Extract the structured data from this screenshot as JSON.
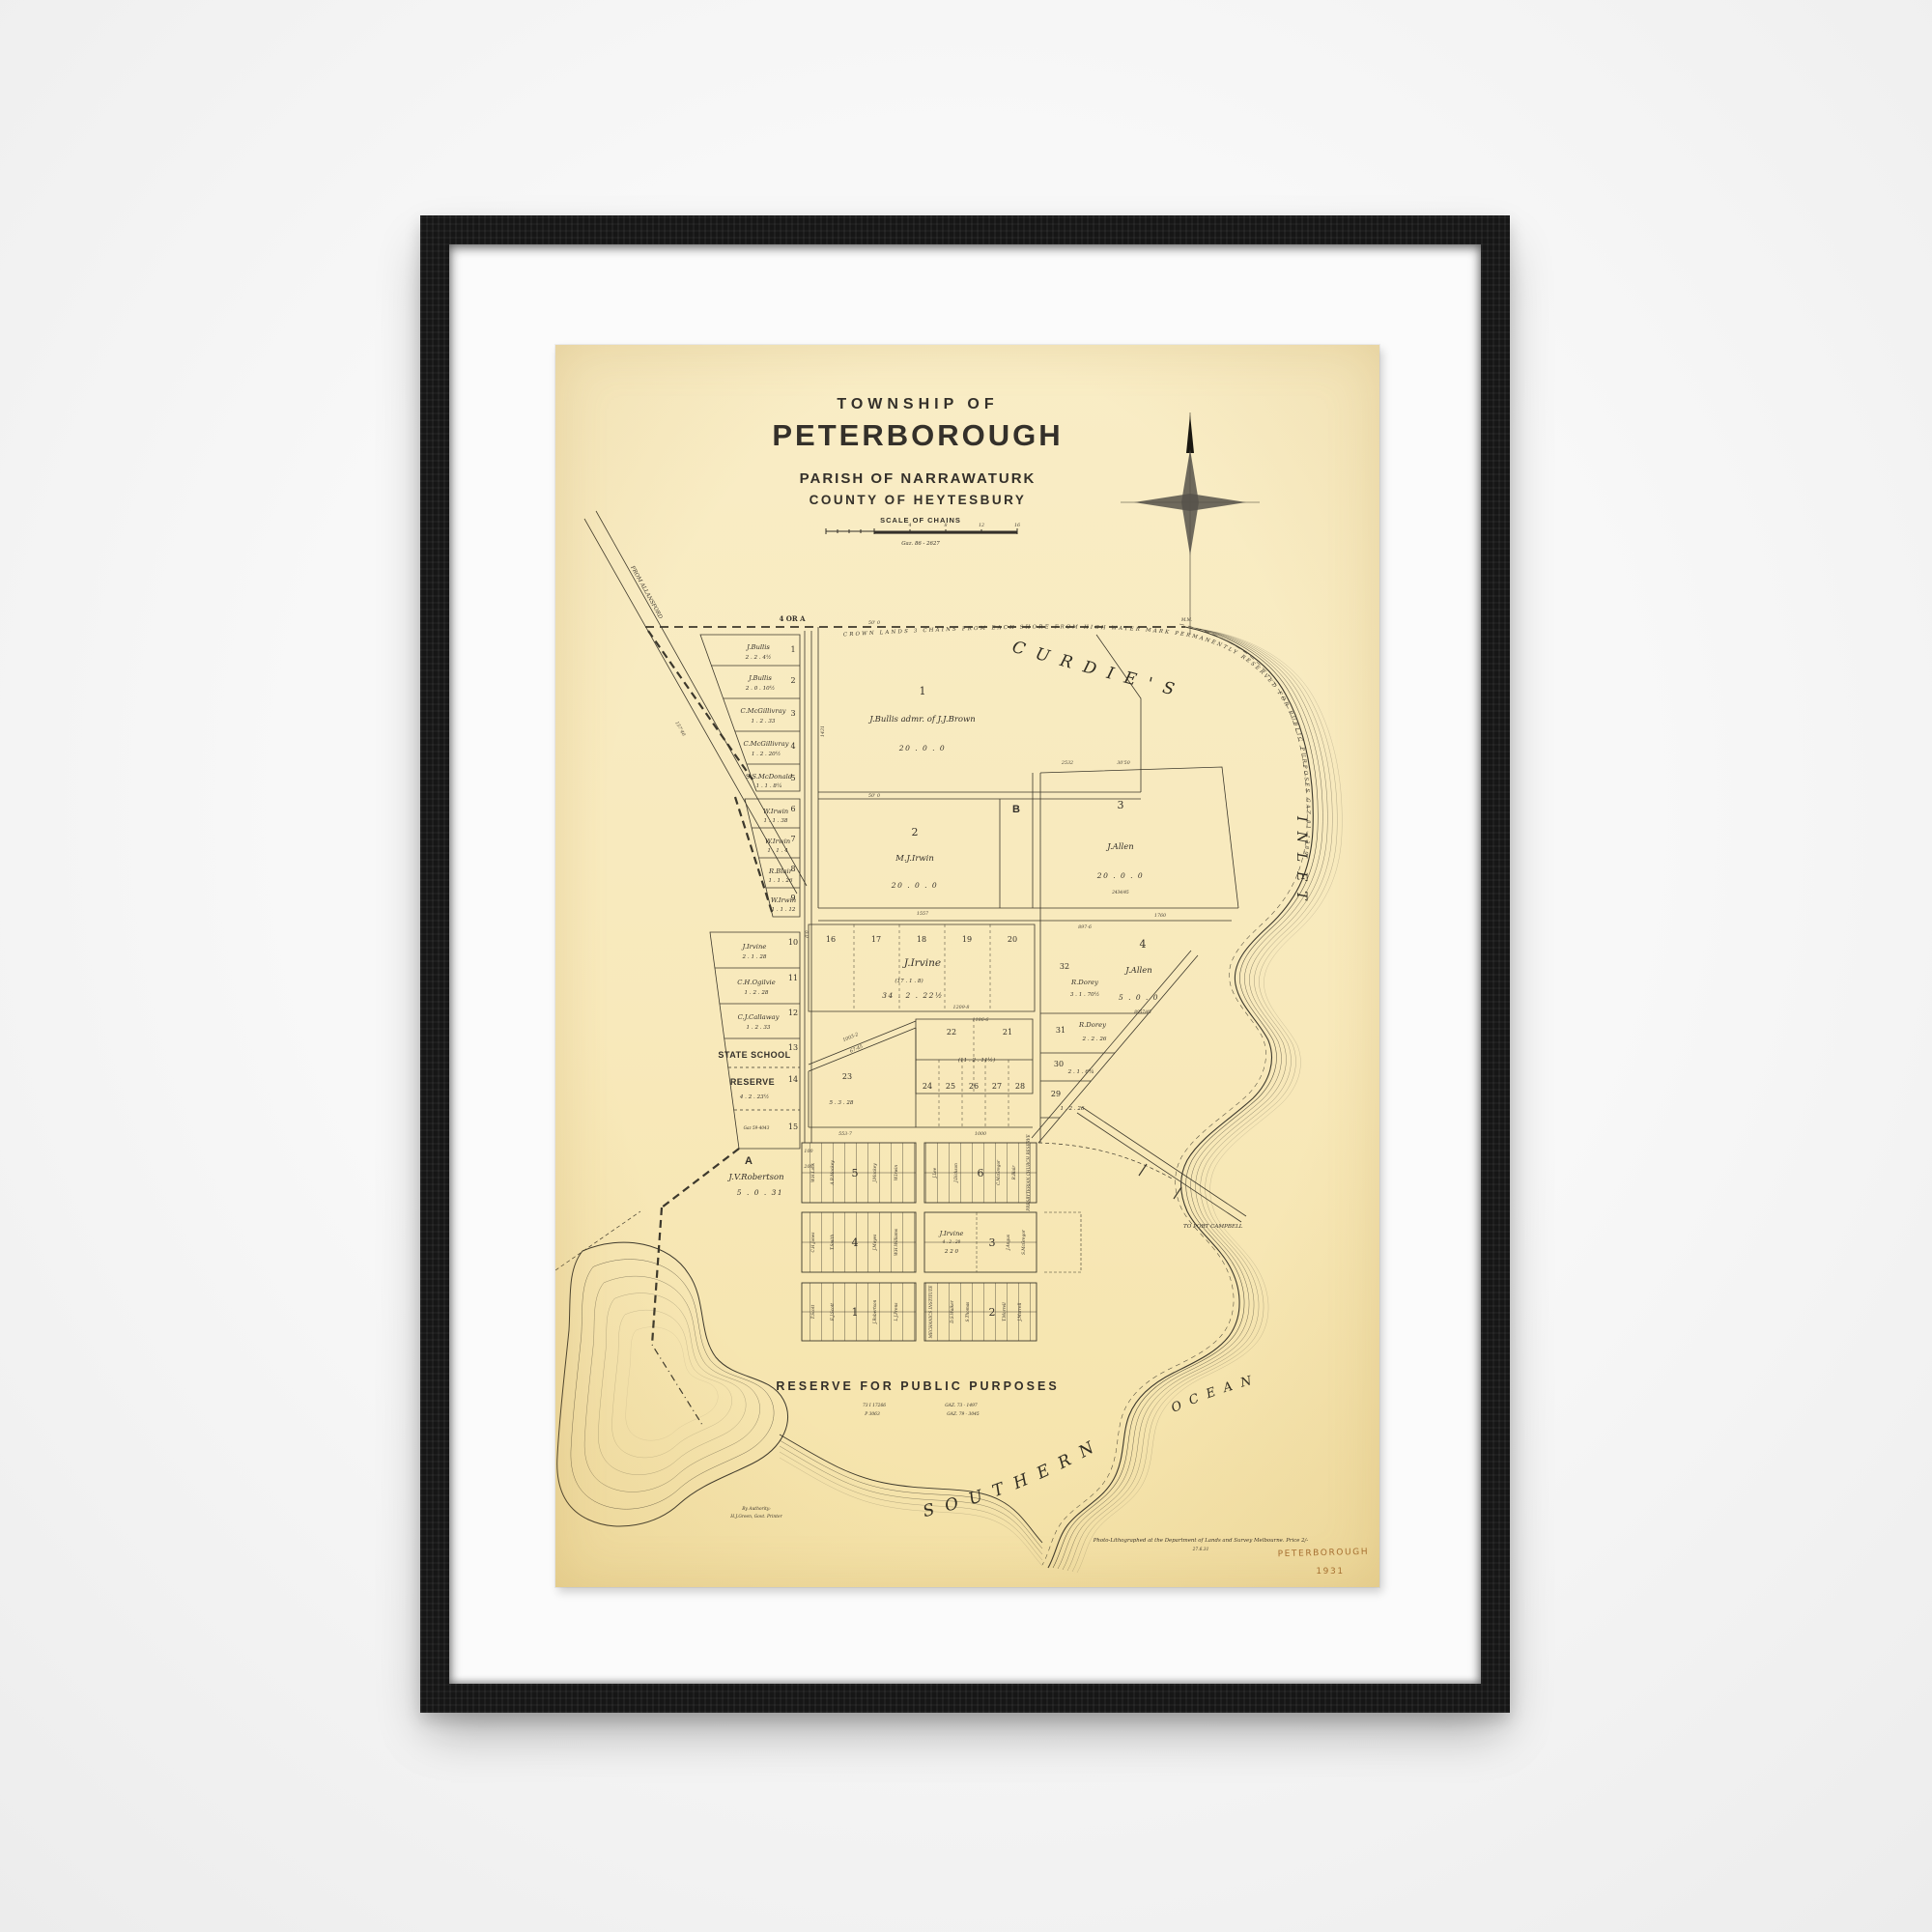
{
  "colors": {
    "background": "#f0f0f0",
    "frame": "#161616",
    "mat": "#fbfbfb",
    "paper": "#f8e9bb",
    "ink": "#34302a",
    "handwriting": "#a2692e"
  },
  "artwork": {
    "title_block": {
      "line1": "TOWNSHIP OF",
      "line2": "PETERBOROUGH",
      "line3": "PARISH OF NARRAWATURK",
      "line4": "COUNTY OF HEYTESBURY",
      "scale_label": "SCALE OF CHAINS",
      "scale_ticks": [
        "4",
        "8",
        "12",
        "16"
      ],
      "gazette_ref": "Gaz. 86 - 2627"
    },
    "boundary_label": "4 OR A",
    "benchmark": "M.M.",
    "roads": {
      "allansford": "FROM ALLANSFORD",
      "port_campbell": "TO PORT CAMPBELL"
    },
    "crown_reserve_note": "CROWN LANDS 3 CHAINS FROM EACH SHORE FROM HIGH WATER MARK PERMANENTLY RESERVED FOR PUBLIC PURPOSES GAZ 81-1389",
    "water": {
      "w1": "CURDIE'S",
      "w2": "INLET",
      "w3": "SOUTHERN",
      "w4": "OCEAN"
    },
    "left_lots": [
      {
        "n": "1",
        "name": "J.Bullis",
        "area": "2 . 2 . 4½"
      },
      {
        "n": "2",
        "name": "J.Bullis",
        "area": "2 . 0 . 10½"
      },
      {
        "n": "3",
        "name": "C.McGillivray",
        "area": "1 . 2 . 33"
      },
      {
        "n": "4",
        "name": "C.McGillivray",
        "area": "1 . 2 . 20½"
      },
      {
        "n": "5",
        "name": "S.S.McDonald",
        "area": "1 . 1 . 8¼"
      },
      {
        "n": "6",
        "name": "W.Irwin",
        "area": "1 . 1 . 38"
      },
      {
        "n": "7",
        "name": "W.Irwin",
        "area": "1 . 1 . 4"
      },
      {
        "n": "8",
        "name": "R.Blair",
        "area": "1 . 1 . 26"
      },
      {
        "n": "9",
        "name": "W.Irwin",
        "area": "1 . 1 . 12"
      }
    ],
    "mid_lots": [
      {
        "n": "10",
        "name": "J.Irvine",
        "area": "2 . 1 . 28"
      },
      {
        "n": "11",
        "name": "C.H.Ogilvie",
        "area": "1 . 2 . 28"
      },
      {
        "n": "12",
        "name": "C.J.Callaway",
        "area": "1 . 2 . 33"
      }
    ],
    "school": {
      "n13": "13",
      "line1": "STATE SCHOOL",
      "line2": "RESERVE",
      "n14": "14",
      "area": "4 . 2 . 23½",
      "n15": "15",
      "gaz": "Gaz 59-4043"
    },
    "parcels": {
      "p1": {
        "n": "1",
        "name": "J.Bullis admr. of J.J.Brown",
        "area": "20 . 0 . 0"
      },
      "p2": {
        "n": "2",
        "name": "M.J.Irwin",
        "area": "20 . 0 . 0"
      },
      "pb": "B",
      "p3": {
        "n": "3",
        "name": "J.Allen",
        "area": "20 . 0 . 0",
        "ref": "2434/45"
      },
      "p4": {
        "n": "4",
        "name": "J.Allen",
        "area": "5 . 0 . 0",
        "ref": "8957/45"
      },
      "p32": {
        "n": "32",
        "name": "R.Dorey",
        "area": "3 . 1 . 70½"
      },
      "p31": {
        "n": "31",
        "name": "R.Dorey",
        "area": "2 . 2 . 26"
      },
      "p30": {
        "n": "30",
        "area": "2 . 1 . 6¾"
      },
      "p29": {
        "n": "29",
        "area": "1 . 2 . 26"
      }
    },
    "irvine_block": {
      "n16": "16",
      "n17": "17",
      "n18": "18",
      "n19": "19",
      "n20": "20",
      "name": "J.Irvine",
      "area_small": "(17 . 1 . 8)",
      "area": "34 . 2 . 22½"
    },
    "block_21_22": {
      "n22": "22",
      "n21": "21",
      "area": "(11 . 2 . 11½)"
    },
    "block_23": {
      "n": "23",
      "area": "5 . 3 . 28"
    },
    "row_24_28": [
      "24",
      "25",
      "26",
      "27",
      "28"
    ],
    "robertson": {
      "letter": "A",
      "name": "J.V.Robertson",
      "area": "5 . 0 . 31"
    },
    "town": {
      "s5": "5",
      "s6": "6",
      "s4": "4",
      "s3": "3",
      "s1": "1",
      "s2": "2",
      "irvine_lot": {
        "name": "J.Irvine",
        "ref": "4 . 2 . 20",
        "area": "2 2 0"
      },
      "mechanics": "MECHANICS INSTITUTE",
      "presbyterian": "PRESBYTERIAN CHURCH RESERVE",
      "names": [
        "W.H.Lock",
        "A.B.Mockey",
        "J.Mockey",
        "W.Irwin",
        "J.Lee",
        "J.Dickson",
        "C.McGregor",
        "R.Blair",
        "C.H.Jones",
        "T.Smith",
        "J.Moyes",
        "W.H.Williams",
        "J.Angus",
        "S.McGregor",
        "T.Scott",
        "E.J.Scott",
        "J.Robertson",
        "L.J.Prens",
        "D.S.Walker",
        "S.Thomas",
        "T.Morrell",
        "J.Morrell"
      ]
    },
    "reserve": {
      "title": "RESERVE FOR PUBLIC PURPOSES",
      "ref1": "73 I 17266",
      "ref2": "P 3063",
      "ref3": "GAZ. 73 - 1497",
      "ref4": "GAZ. 79 - 3045"
    },
    "imprint": {
      "line": "Photo-Lithographed at the Department of Lands and Survey Melbourne.  Price 2/-",
      "date": "27.6.31",
      "authority1": "By Authority:",
      "authority2": "H.J.Green, Govt. Printer"
    },
    "handwritten": {
      "title": "PETERBOROUGH",
      "year": "1931"
    },
    "dims": [
      "50' 0",
      "1557",
      "1760",
      "1209-8",
      "1003-2",
      "67-45",
      "553-7",
      "1000",
      "1186-6",
      "2532",
      "30'50",
      "897-6",
      "100",
      "200",
      "157'40",
      "1431",
      "0'0",
      "50' 0"
    ]
  }
}
